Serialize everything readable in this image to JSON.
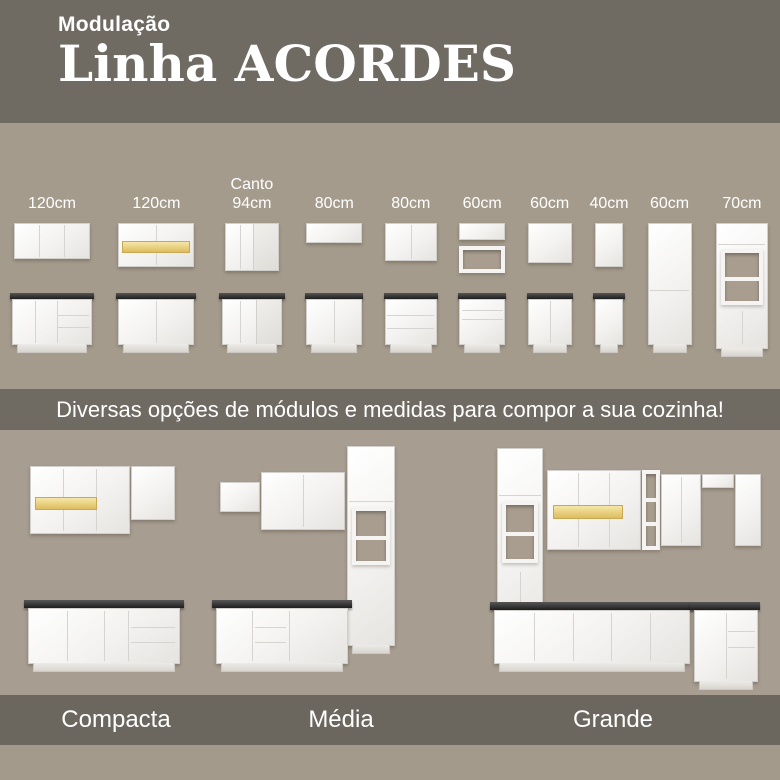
{
  "colors": {
    "header_bg": "#6F6A62",
    "modules_bg": "#A49B8C",
    "banner_bg": "#6F6A62",
    "kitchens_bg": "#A79D90",
    "labels_band_bg": "#6B665E",
    "footer_bg": "#A49A8C",
    "text": "#FFFFFF",
    "cabinet_white": "#F5F4F2",
    "countertop_dark": "#2A2A2A",
    "led_amber": "#E5C568"
  },
  "header": {
    "kicker": "Modulação",
    "title": "Linha ACORDES"
  },
  "modules": {
    "items": [
      {
        "size": "120cm"
      },
      {
        "size": "120cm"
      },
      {
        "prefix": "Canto",
        "size": "94cm"
      },
      {
        "size": "80cm"
      },
      {
        "size": "80cm"
      },
      {
        "size": "60cm"
      },
      {
        "size": "60cm"
      },
      {
        "size": "40cm"
      },
      {
        "size": "60cm"
      },
      {
        "size": "70cm"
      }
    ]
  },
  "banner": {
    "text": "Diversas opções de módulos e medidas para compor a sua cozinha!"
  },
  "kitchens": {
    "items": [
      {
        "label": "Compacta"
      },
      {
        "label": "Média"
      },
      {
        "label": "Grande"
      }
    ]
  }
}
